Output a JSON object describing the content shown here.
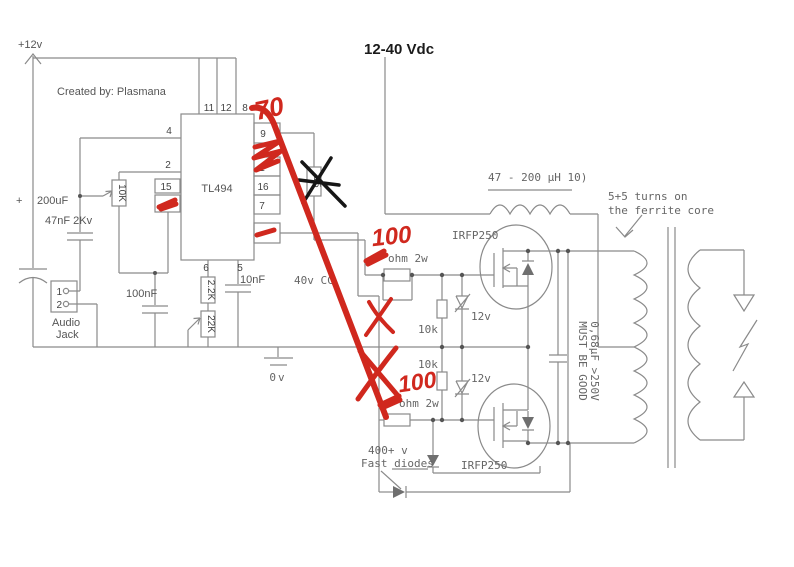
{
  "title": {
    "supply_left": "+12v",
    "supply_right": "12-40 Vdc",
    "created_by": "Created by: Plasmana"
  },
  "ic": {
    "name": "TL494",
    "pins_top": [
      "11",
      "12",
      "8"
    ],
    "pins_left": [
      "4",
      "2",
      "15"
    ],
    "pins_right": [
      "9",
      "1",
      "16",
      "7"
    ],
    "pins_bottom": [
      "6",
      "5"
    ],
    "crossed_resistor_value": "15"
  },
  "left": {
    "plus": "+",
    "cap_input": "200uF",
    "cap_hv": "47nF 2Kv",
    "jack_pin1": "1",
    "jack_pin2": "2",
    "jack_label1": "Audio",
    "jack_label2": "Jack",
    "pot_feedback": "10K",
    "cap_100nf": "100nF",
    "res_2k2": "2.2K",
    "pot_22k": "22K",
    "cap_10nf": "10nF",
    "ground": "0v"
  },
  "driver": {
    "note": "40v CC",
    "gate_res_upper": "ohm 2w",
    "gate_res_lower": "ohm 2w",
    "pulldown_upper": "10k",
    "pulldown_lower": "10k",
    "zener_upper": "12v",
    "zener_lower": "12v",
    "mosfet_upper": "IRFP250",
    "mosfet_lower": "IRFP250",
    "diode_note1": "400+ v",
    "diode_note2": "Fast diodes"
  },
  "output": {
    "inductor": "47 - 200 µH 10)",
    "tank_cap1": "0,68µF >250V",
    "tank_cap2": "MUST BE GOOD",
    "turns1": "5+5 turns on",
    "turns2": "the ferrite core"
  },
  "annotations": {
    "red_top": "70",
    "red_gate_value": "100",
    "red_x100_value": "100"
  }
}
